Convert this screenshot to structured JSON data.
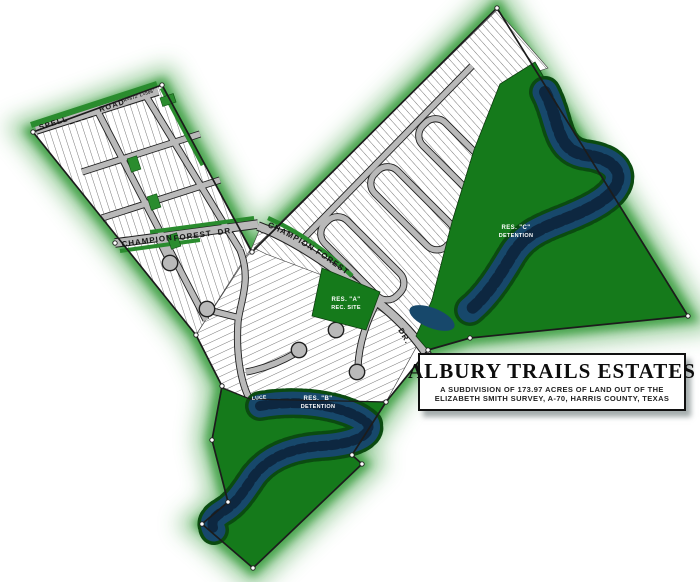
{
  "title_block": {
    "title": "ALBURY TRAILS ESTATES",
    "line1": "A SUBDIVISION OF 173.97 ACRES OF LAND OUT OF THE",
    "line2": "ELIZABETH SMITH SURVEY, A-70, HARRIS COUNTY, TEXAS"
  },
  "roads": {
    "spell_left": "SPELL",
    "spell_right": "ROAD",
    "spell_curve_note": "R=672'  L=506'",
    "champion_left_1": "CHAMPION",
    "champion_left_2": "FOREST",
    "champion_left_3": "DR.",
    "champion_center": "CHAMPION    FOREST",
    "champion_exit": "DR.",
    "luce": "LUCE"
  },
  "reserves": {
    "res_a_1": "RES. \"A\"",
    "res_a_2": "REC. SITE",
    "res_b_1": "RES. \"B\"",
    "res_b_2": "DETENTION",
    "res_c_1": "RES. \"C\"",
    "res_c_2": "DETENTION"
  },
  "colors": {
    "glow_green": "#3b9e41",
    "reserve_green": "#157a1b",
    "buffer_green": "#2a8c2e",
    "pond_navy": "#17486b",
    "road_gray": "#b9b9b9",
    "ink": "#1c1c1c"
  }
}
